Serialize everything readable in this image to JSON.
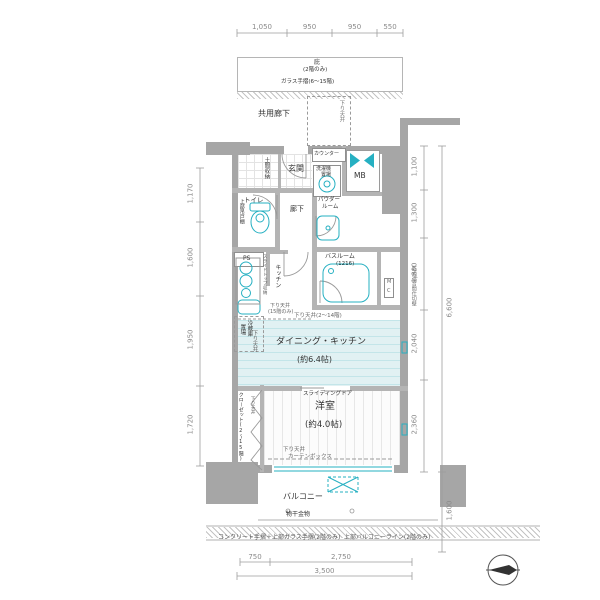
{
  "colors": {
    "accent": "#26b0c2",
    "wall": "#a6a6a6",
    "dim": "#8a8a8a"
  },
  "top": {
    "eave": "庇",
    "eave_note": "(2階のみ)",
    "glass_rail": "ガラス手摺(6〜15階)",
    "common_corridor": "共用廊下",
    "dropped_ceiling": "下り天井"
  },
  "entry": {
    "genkan": "玄関",
    "doma_storage": "土間収納",
    "counter": "カウンター",
    "mb": "MB",
    "washer_l1": "洗濯機",
    "washer_l2": "置場",
    "toilet": "トイレ",
    "upper_cabinet": "上部吊戸棚",
    "hall": "廊下",
    "powder_l1": "パウダー",
    "powder_l2": "ルーム",
    "ps": "PS",
    "meter_m": "M",
    "meter_c": "C"
  },
  "kitchen": {
    "label": "キッチン",
    "slide_storage": "スライドトップ収納",
    "fridge_l1": "冷蔵庫",
    "fridge_l2": "置場",
    "bath": "バスルーム",
    "bath_size": "(1216)",
    "dc_15_l1": "下り天井",
    "dc_15_l2": "(15階のみ)",
    "dc_2_14": "下り天井(2〜14階)"
  },
  "living": {
    "dk": "ダイニング・キッチン",
    "dk_size": "(約6.4帖)",
    "dc": "下り天井",
    "sliding_door": "スライディングドア",
    "bedroom": "洋室",
    "bedroom_size": "(約4.0帖)",
    "closet": "クローゼット(2〜15階)",
    "closet_dc": "下り天井",
    "dc2": "下り天井",
    "curtain_box": "カーテンボックス"
  },
  "balcony": {
    "label": "バルコニー",
    "drying": "物干金物"
  },
  "notes": {
    "partition": "乾式遮音間仕切壁",
    "left": "コンクリート手摺＋上部ガラス手摺(2階のみ)",
    "right": "上部バルコニーライン(2階のみ)"
  },
  "dimensions": {
    "top": [
      "1,050",
      "950",
      "950",
      "550"
    ],
    "left": [
      "1,170",
      "1,600",
      "1,950",
      "1,720"
    ],
    "right": [
      "1,100",
      "1,300",
      "1,800",
      "2,040",
      "2,360"
    ],
    "right_total": "6,600",
    "right_balcony": "1,600",
    "bottom": [
      "750",
      "2,750"
    ],
    "bottom_total": "3,500"
  }
}
